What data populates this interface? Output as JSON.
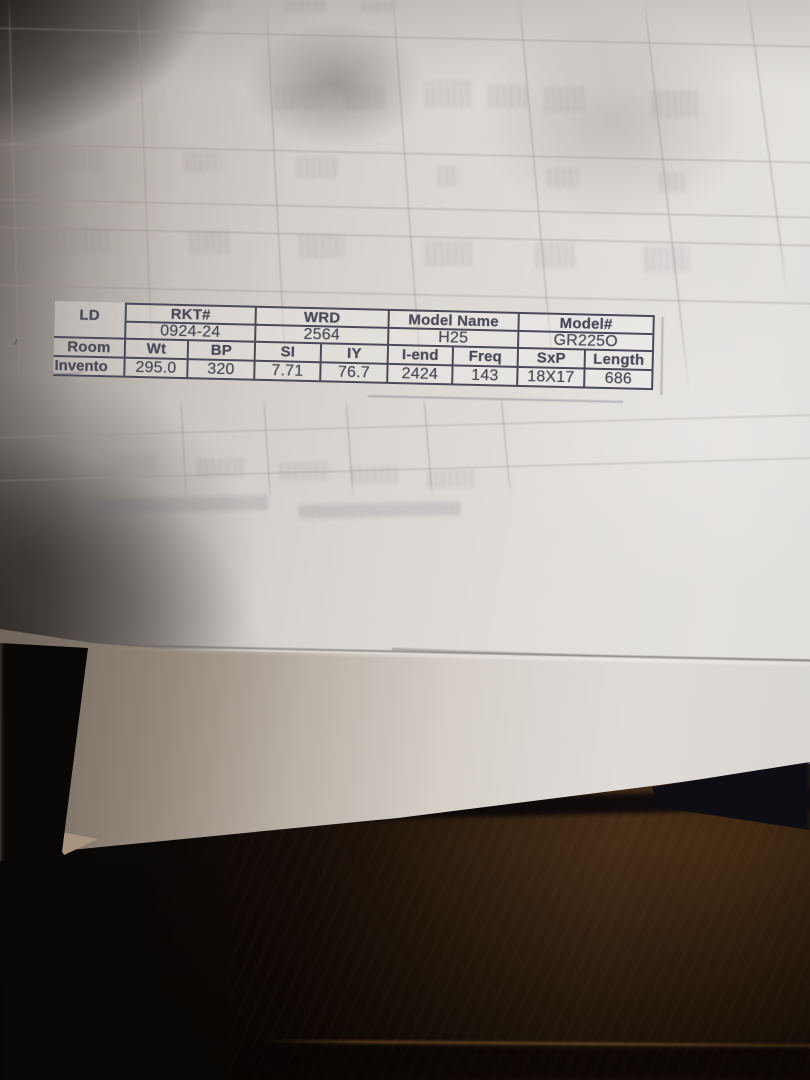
{
  "document_table": {
    "left_labels": [
      "LD",
      "Room",
      "Invento"
    ],
    "groups": [
      {
        "header": "RKT#",
        "value": "0924-24"
      },
      {
        "header": "WRD",
        "value": "2564"
      },
      {
        "header": "Model Name",
        "value": "H25"
      },
      {
        "header": "Model#",
        "value": "GR225O"
      }
    ],
    "columns": [
      {
        "header": "Wt",
        "value": "295.0"
      },
      {
        "header": "BP",
        "value": "320"
      },
      {
        "header": "SI",
        "value": "7.71"
      },
      {
        "header": "IY",
        "value": "76.7"
      },
      {
        "header": "I-end",
        "value": "2424"
      },
      {
        "header": "Freq",
        "value": "143"
      },
      {
        "header": "SxP",
        "value": "18X17"
      },
      {
        "header": "Length",
        "value": "686"
      }
    ]
  },
  "chart_data": {
    "type": "table",
    "title": "Printed spec label on paper",
    "rows": [
      [
        "LD",
        "RKT#: 0924-24",
        "WRD: 2564",
        "Model Name: H25",
        "Model#: GR225O"
      ],
      [
        "Room / Invento",
        "Wt: 295.0",
        "BP: 320",
        "SI: 7.71",
        "IY: 76.7",
        "I-end: 2424",
        "Freq: 143",
        "SxP: 18X17",
        "Length: 686"
      ]
    ]
  },
  "colors": {
    "ink": "#474756",
    "paper_light": "#e3e1de",
    "paper_shadow": "#8f8984",
    "wood": "#3b2715",
    "deep_shadow": "#090706"
  }
}
